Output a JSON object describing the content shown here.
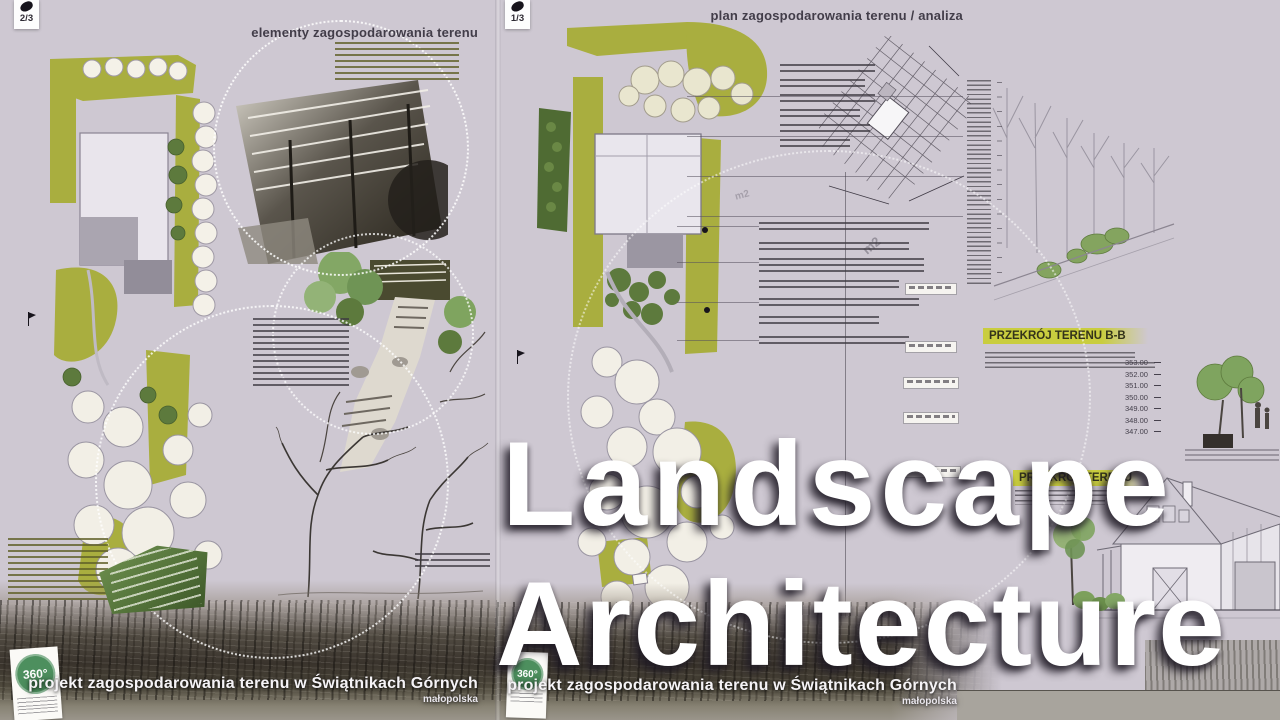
{
  "overlay": {
    "line1": "Landscape",
    "line2": "Architecture"
  },
  "boards": {
    "left": {
      "page_marker": "2/3",
      "header": "elementy zagospodarowania terenu",
      "caption": "projekt zagospodarowania terenu w Świątnikach Górnych",
      "region": "małopolska",
      "logo": "360°"
    },
    "right": {
      "page_marker": "1/3",
      "header": "plan zagospodarowania terenu / analiza",
      "section_b_title": "PRZEKRÓJ TERENU B-B",
      "section_a_title": "PRZEKRÓJ TERENU",
      "elevations": [
        "353.00",
        "352.00",
        "351.00",
        "350.00",
        "349.00",
        "348.00",
        "347.00"
      ],
      "area_label": "m2",
      "caption": "projekt zagospodarowania terenu w Świątnikach Górnych",
      "region": "małopolska",
      "logo": "360°"
    }
  },
  "colors": {
    "board_bg": "#cec8d2",
    "olive": "#a9ae3f",
    "yellow_highlight": "#c9cd3f",
    "dark_green": "#55703a",
    "overlay_text": "#ffffff"
  }
}
